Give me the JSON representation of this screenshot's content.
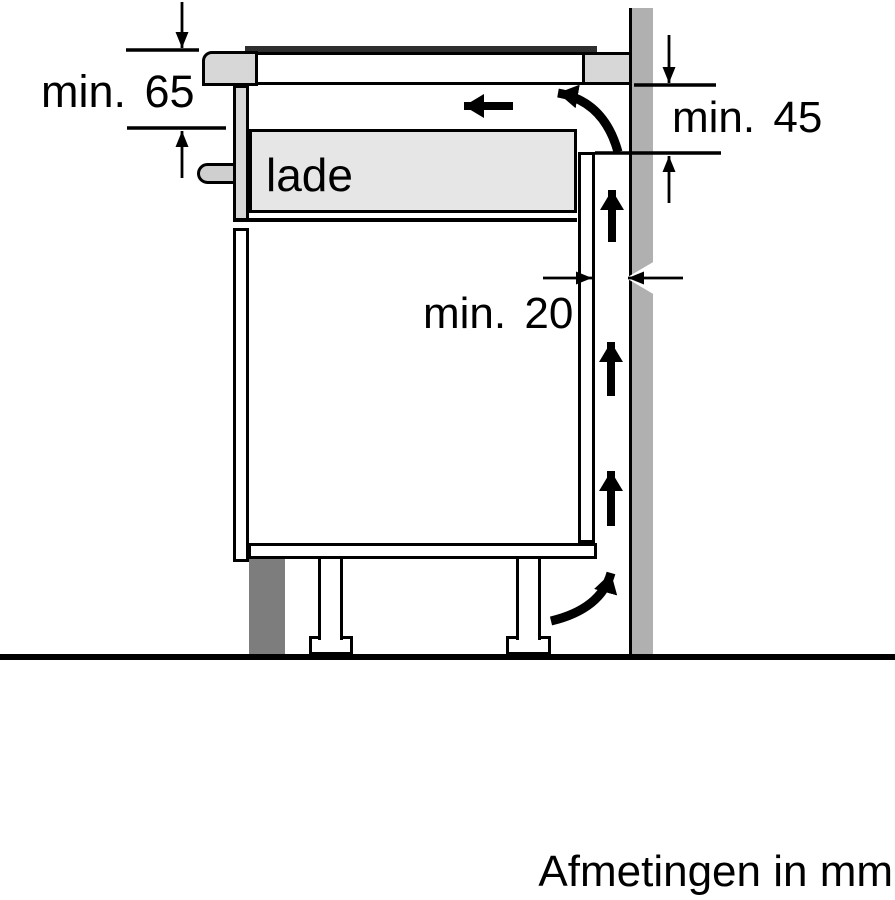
{
  "diagram": {
    "drawer_label": "lade",
    "footer_note": "Afmetingen in mm",
    "dimensions": {
      "hob_clearance": "min. 65",
      "back_clearance": "min. 45",
      "wall_gap": "min. 20"
    },
    "colors": {
      "background": "#ffffff",
      "line": "#000000",
      "wall": "#b0b0b0",
      "panel_light": "#d7d7d7",
      "drawer_fill": "#e6e6e6",
      "plinth": "#7d7d7d",
      "glass_top": "#2f2f2f"
    }
  }
}
